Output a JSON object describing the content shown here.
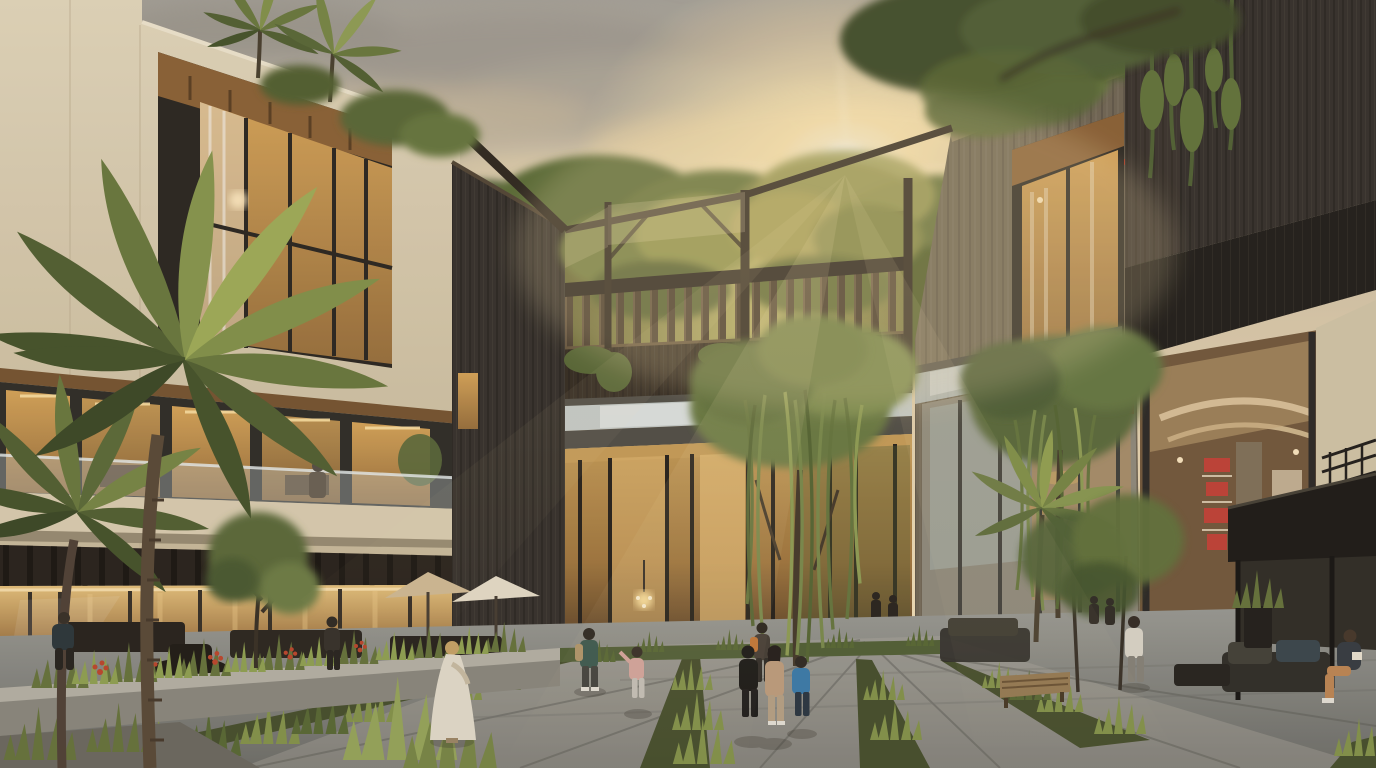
{
  "scene": {
    "type": "architectural-rendering",
    "description": "Sunset courtyard view of a modern mixed-use complex: cream limestone building on the left with golden lit glazing, a dark timber bridge with roof-garden balustrade spanning the center, charcoal wood retail building on the right, lush palms, weeping willows, planted paving strips and people strolling in the plaza while the sun flares between the rooflines.",
    "time_of_day": "golden hour sunset",
    "weather": "warm hazy sky with soft grey and gold clouds"
  },
  "palette": {
    "sky_top": "#a9a59d",
    "sky_mid": "#ddccae",
    "sky_warm": "#f4e1ba",
    "sun_core": "#fffcf0",
    "sun_glow": "#ffe9b5",
    "cloud_grey": "#a39d93",
    "cloud_warm": "#d9c6a4",
    "cream_wall": "#e6dabf",
    "cream_shadow": "#c9ba9b",
    "wood_soffit": "#8f653a",
    "window_gold": "#d9a75c",
    "window_amber": "#9c7340",
    "frame_dark": "#2e2a25",
    "charcoal_wood": "#3a3530",
    "charcoal_deep": "#26231f",
    "mid_wood": "#746a59",
    "bridge_wood": "#3a3127",
    "baluster_wood": "#55473a",
    "foliage_dark": "#43502c",
    "foliage_mid": "#5f6f3b",
    "foliage_light": "#8b9a51",
    "foliage_backlit": "#c2ba70",
    "willow": "#74844a",
    "paving": "#9d9d97",
    "paving_shadow": "#71716c",
    "planter_stone": "#8e8b81",
    "glass_sky": "#c3ced0",
    "red_display": "#c23b2e",
    "umbrella_tan": "#d3bd97",
    "umbrella_cream": "#e9e0cb",
    "person_white": "#e6dfcf",
    "person_teal": "#3f5c52",
    "person_blue": "#3f7fae",
    "person_tan": "#c2a181",
    "person_pink": "#d8a8a0"
  },
  "elements": {
    "left_building": "cream stone facade, recessed wood-lined picture window, lit glazing bands, balcony with glass rail, pergola over storefront terrace",
    "bridge": "dark timber footbridge with slatted balustrade and roof garden, open trellis frame above, glass atrium below with chandelier",
    "mid_building": "grey-brown plank facade with recessed curtained window and rooftop planting",
    "right_building": "charcoal vertical-plank volume with hanging vines, angled soffit, double-height retail glazing with cove lighting and red merchandise shelves",
    "plaza": "grey stone paving with planted grass joints, stone planters with red flowers, benches, umbrellas, outdoor lounge pavilion",
    "vegetation": "foreground coconut palms, two weeping willows, rooftop palms, background tropical tree line, agave and grass tufts"
  },
  "people": [
    {
      "label": "man-on-balcony",
      "where": "left building balcony",
      "look": "grey suit"
    },
    {
      "label": "seated-man-left",
      "where": "left terrace bench",
      "look": "dark navy top"
    },
    {
      "label": "standing-figure-left",
      "where": "left terrace tables",
      "look": "dark clothing"
    },
    {
      "label": "woman-white-dress",
      "where": "seated on planter bench",
      "look": "long white dress, blonde hair"
    },
    {
      "label": "man-teal-backpack",
      "where": "center path",
      "look": "teal shirt, tan backpack"
    },
    {
      "label": "child-pink",
      "where": "center path",
      "look": "pink outfit"
    },
    {
      "label": "person-black-hoodie",
      "where": "main walkway",
      "look": "black hoodie"
    },
    {
      "label": "woman-tan-coat",
      "where": "main walkway",
      "look": "beige coat, dark hair"
    },
    {
      "label": "man-orange-pack",
      "where": "main walkway ahead",
      "look": "dark clothes, orange backpack"
    },
    {
      "label": "kid-blue-jacket",
      "where": "main walkway",
      "look": "blue jacket, jeans"
    },
    {
      "label": "man-white-shirt",
      "where": "right path",
      "look": "white long-sleeve, grey trousers"
    },
    {
      "label": "seated-man-pavilion",
      "where": "right lounge sofa",
      "look": "dark jacket, tan trousers"
    },
    {
      "label": "background-pair",
      "where": "atrium entry",
      "look": "small silhouettes"
    },
    {
      "label": "background-shoppers",
      "where": "mid building door",
      "look": "small silhouettes"
    }
  ]
}
